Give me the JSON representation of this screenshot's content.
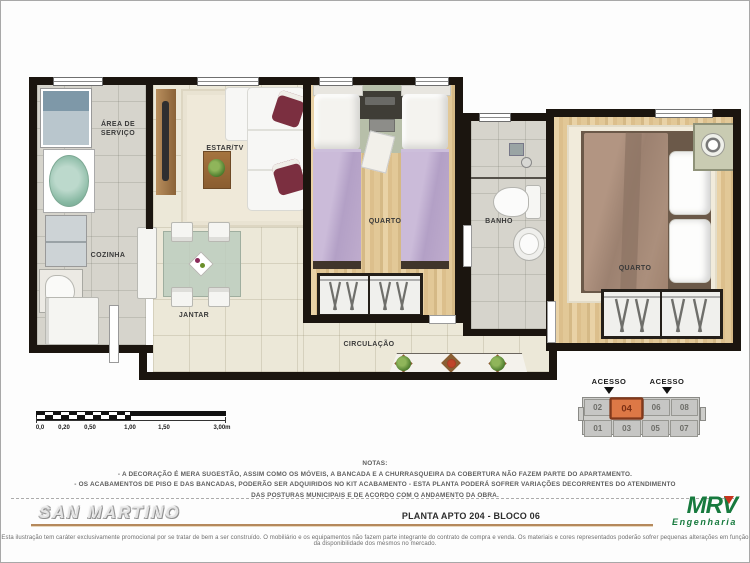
{
  "plan": {
    "rooms": {
      "area_servico": {
        "line1": "ÁREA DE",
        "line2": "SERVIÇO"
      },
      "cozinha": {
        "label": "COZINHA"
      },
      "estar": {
        "label": "ESTAR/TV"
      },
      "jantar": {
        "label": "JANTAR"
      },
      "quarto1": {
        "label": "QUARTO"
      },
      "banho": {
        "label": "BANHO"
      },
      "quarto2": {
        "label": "QUARTO"
      },
      "circulacao": {
        "label": "CIRCULAÇÃO"
      }
    }
  },
  "scalebar": {
    "labels": [
      "0,0",
      "0,20",
      "0,50",
      "1,00",
      "1,50",
      "3,00m"
    ]
  },
  "keyplan": {
    "access_label_1": "ACESSO",
    "access_label_2": "ACESSO",
    "units_top": [
      "02",
      "04",
      "06",
      "08"
    ],
    "units_bottom": [
      "01",
      "03",
      "05",
      "07"
    ],
    "highlighted_unit": "04",
    "highlight_color": "#dd7846"
  },
  "notes": {
    "title": "NOTAS:",
    "lines": [
      "- A DECORAÇÃO É MERA SUGESTÃO, ASSIM COMO OS MÓVEIS, A BANCADA E A CHURRASQUEIRA DA COBERTURA NÃO FAZEM PARTE DO APARTAMENTO.",
      "- OS ACABAMENTOS DE PISO E DAS BANCADAS, PODERÃO SER ADQUIRIDOS NO KIT ACABAMENTO  -  ESTA PLANTA PODERÁ SOFRER VARIAÇÕES DECORRENTES DO ATENDIMENTO",
      "DAS POSTURAS  MUNICIPAIS E DE ACORDO COM O ANDAMENTO DA OBRA."
    ]
  },
  "footer": {
    "project_name": "SAN MARTINO",
    "plan_title": "PLANTA APTO 204 - BLOCO 06",
    "brand_name": "MRV",
    "brand_subtitle": "Engenharia",
    "disclaimer": "Esta ilustração tem caráter exclusivamente promocional por se tratar de bem a ser construído. O mobiliário e os equipamentos não fazem parte integrante do contrato de compra e venda. Os materiais e cores representados poderão sofrer pequenas alterações em função da disponibilidade dos mesmos no mercado."
  }
}
